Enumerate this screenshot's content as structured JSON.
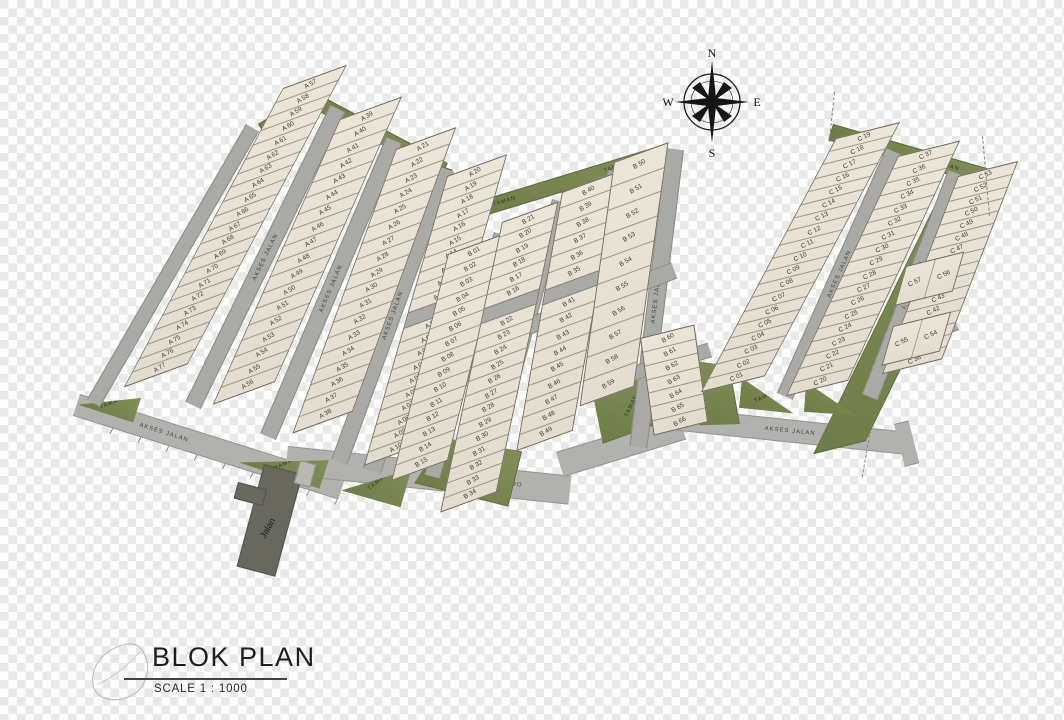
{
  "title": {
    "main": "BLOK PLAN",
    "scale": "SCALE  1 : 1000"
  },
  "compass": {
    "n": "N",
    "e": "E",
    "s": "S",
    "w": "W"
  },
  "labels": {
    "akses": "AKSES JALAN",
    "metro": "JALAN METRO",
    "jalan": "Jalan",
    "taman": "TAMAN"
  },
  "colors": {
    "lot_fill": "#eae4d6",
    "road_gray": "#a9a9a5",
    "dark_road": "#68685f",
    "park_green": "#78874f",
    "ink": "#1f1f1c"
  },
  "blocks": {
    "A": {
      "columns": [
        {
          "el": "col-a1",
          "lots": [
            "A 57",
            "A 58",
            "A 59",
            "A 60",
            "A 61",
            "A 62",
            "A 63",
            "A 64",
            "A 65",
            "A 66",
            "A 67",
            "A 68",
            "A 69",
            "A 70",
            "A 71",
            "A 72",
            "A 73",
            "A 74",
            "A 75",
            "A 76",
            "A 77"
          ]
        },
        {
          "el": "col-a2",
          "lots": [
            "A 39",
            "A 40",
            "A 41",
            "A 42",
            "A 43",
            "A 44",
            "A 45",
            "A 46",
            "A 47",
            "A 48",
            "A 49",
            "A 50",
            "A 51",
            "A 52",
            "A 53",
            "A 54",
            "A 55",
            "A 56"
          ]
        },
        {
          "el": "col-a3",
          "lots": [
            "A 21",
            "A 22",
            "A 23",
            "A 24",
            "A 25",
            "A 26",
            "A 27",
            "A 28",
            "A 29",
            "A 30",
            "A 31",
            "A 32",
            "A 33",
            "A 34",
            "A 35",
            "A 36",
            "A 37",
            "A 38"
          ]
        },
        {
          "el": "col-a4",
          "road_after": 9,
          "lots": [
            "A 20",
            "A 19",
            "A 18",
            "A 17",
            "A 16",
            "A 15",
            "A 14",
            "A 13",
            "A 12",
            "A 11",
            "A 01",
            "A 02",
            "A 03",
            "A 04",
            "A 05",
            "A 06",
            "A 07",
            "A 08",
            "A 09",
            "A 10"
          ]
        }
      ]
    },
    "B": {
      "columns": [
        {
          "el": "col-b1",
          "lots": [
            "B 01",
            "B 02",
            "B 03",
            "B 04",
            "B 05",
            "B 06",
            "B 07",
            "B 08",
            "B 09",
            "B 10",
            "B 11",
            "B 12",
            "B 13",
            "B 14",
            "B 15"
          ]
        },
        {
          "el": "col-b2",
          "road_after": 5,
          "lots": [
            "B 21",
            "B 20",
            "B 19",
            "B 18",
            "B 17",
            "B 16",
            "B 22",
            "B 23",
            "B 24",
            "B 25",
            "B 26",
            "B 27",
            "B 28",
            "B 29",
            "B 30",
            "B 31",
            "B 32",
            "B 33",
            "B 34"
          ]
        },
        {
          "el": "col-b3",
          "road_after": 5,
          "lots": [
            "B 40",
            "B 39",
            "B 38",
            "B 37",
            "B 36",
            "B 35",
            "B 41",
            "B 42",
            "B 43",
            "B 44",
            "B 45",
            "B 46",
            "B 47",
            "B 48",
            "B 49"
          ]
        },
        {
          "el": "col-b4",
          "lots": [
            "B 50",
            "B 51",
            "B 52",
            "B 53",
            "B 54",
            "B 55",
            "B 56",
            "B 57",
            "B 58",
            "B 59"
          ]
        },
        {
          "el": "col-b5",
          "lots": [
            "B 60",
            "B 61",
            "B 62",
            "B 63",
            "B 64",
            "B 65",
            "B 66"
          ]
        }
      ]
    },
    "C": {
      "columns": [
        {
          "el": "col-c1",
          "lots": [
            "C 19",
            "C 18",
            "C 17",
            "C 16",
            "C 15",
            "C 14",
            "C 13",
            "C 12",
            "C 11",
            "C 10",
            "C 09",
            "C 08",
            "C 07",
            "C 06",
            "C 05",
            "C 04",
            "C 03",
            "C 02",
            "C 01"
          ]
        },
        {
          "el": "col-c2",
          "lots": [
            "C 37",
            "C 36",
            "C 35",
            "C 34",
            "C 33",
            "C 32",
            "C 31",
            "C 30",
            "C 29",
            "C 28",
            "C 27",
            "C 26",
            "C 25",
            "C 24",
            "C 23",
            "C 22",
            "C 21",
            "C 20"
          ]
        },
        {
          "el": "col-c3",
          "lots": [
            "C 53",
            "C 52",
            "C 51",
            "C 50",
            "C 49",
            "C 48",
            "C 47",
            "C 46",
            "C 45",
            "C 44",
            "C 43",
            "C 42",
            "C 41",
            "C 40",
            "C 39",
            "C 38"
          ]
        },
        {
          "el": "col-c4a",
          "lots": [
            "C 57",
            "C 56"
          ]
        },
        {
          "el": "col-c4b",
          "lots": [
            "C 55",
            "C 54"
          ]
        }
      ]
    }
  }
}
